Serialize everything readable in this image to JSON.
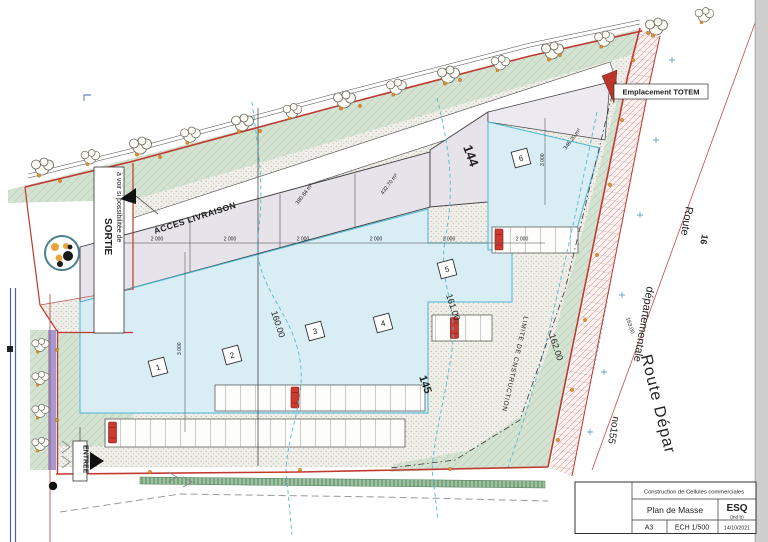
{
  "title_block": {
    "project": "Construction de Cellules commerciales",
    "drawing_title": "Plan de Masse",
    "phase": "ESQ",
    "phase_index": "(ind b)",
    "paper_size": "A3",
    "scale": "ECH 1/500",
    "date": "14/10/2021"
  },
  "plan": {
    "access_label": "ACCES LIVRAISON",
    "totem_label": "Emplacement TOTEM",
    "limit_label": "LIMITE DE CNSTRUCTION",
    "sortie_note": "à voir si possibilitée de",
    "sortie_label": "SORTIE",
    "entree_label": "ENTREE",
    "cells": [
      "1",
      "2",
      "3",
      "4",
      "5",
      "6"
    ],
    "parcels": {
      "p144": "144",
      "p145": "145"
    },
    "contours": {
      "c160": "160.00",
      "c161": "161.00",
      "c162": "162.00",
      "c163": "163.00"
    },
    "dims": {
      "bay": "2 000",
      "depth": "3 000"
    },
    "areas": {
      "a1": "380.84 m²",
      "a2": "432.70 m²",
      "a3": "346.20 m²"
    },
    "road": {
      "name_line1": "Route",
      "name_line2": "départementale",
      "name_line3": "no155",
      "name_black": "Route Dépar",
      "green_ref": "16"
    }
  },
  "colors": {
    "boundary_red": "#c0392e",
    "footprint_blue": "#d9edf5",
    "building_gray": "#e6e3ea",
    "landscape_green": "#d5e3d3",
    "dim_blue": "#3746c8",
    "parcel_red": "#c23a35",
    "route_green": "#1b7f3c",
    "car_red": "#cc3b30",
    "contour_cyan": "#5ab6cf"
  }
}
